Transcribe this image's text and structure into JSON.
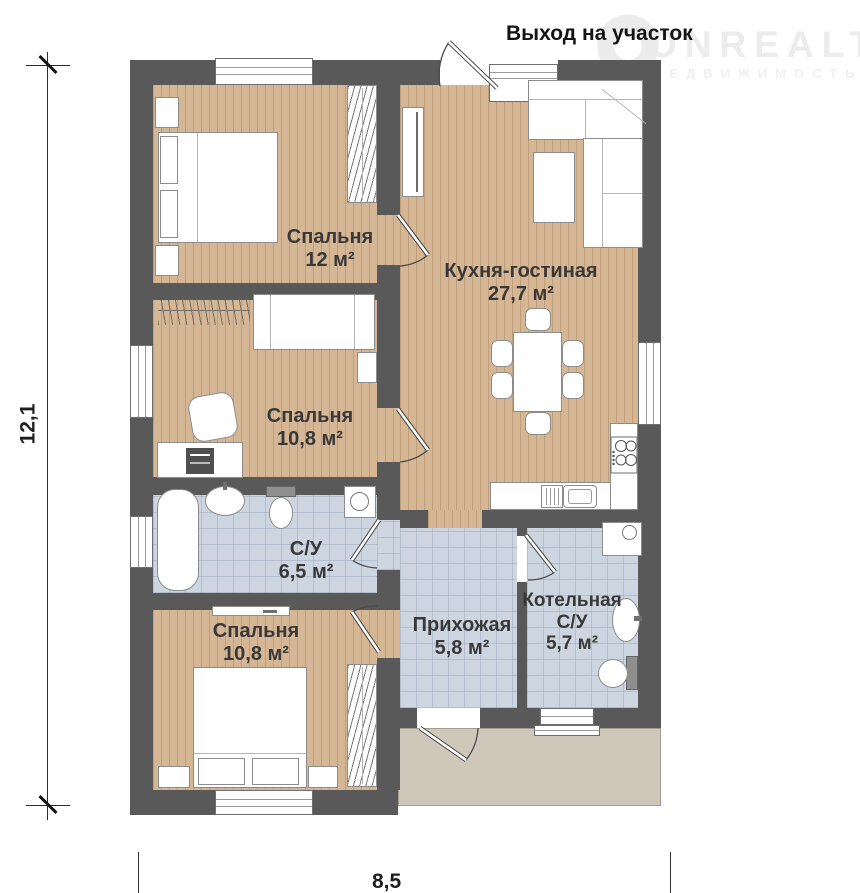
{
  "watermark": {
    "brand": "ONREALT",
    "subtitle": "НЕДВИЖИМОСТЬ"
  },
  "annotations": {
    "exit": "Выход на участок"
  },
  "dimensions": {
    "height_m": "12,1",
    "width_m": "8,5"
  },
  "rooms": {
    "bedroom1": {
      "name": "Спальня",
      "area": "12 м²"
    },
    "kitchen": {
      "name": "Кухня-гостиная",
      "area": "27,7 м²"
    },
    "bedroom2": {
      "name": "Спальня",
      "area": "10,8 м²"
    },
    "bathroom": {
      "name": "С/У",
      "area": "6,5 м²"
    },
    "bedroom3": {
      "name": "Спальня",
      "area": "10,8 м²"
    },
    "hallway": {
      "name": "Прихожая",
      "area": "5,8 м²"
    },
    "boiler": {
      "name": "Котельная",
      "name2": "С/У",
      "area": "5,7 м²"
    }
  },
  "colors": {
    "wall": "#595959",
    "wood_floor": "#d6b795",
    "tile_floor": "#cdd6e0",
    "porch": "#cfc8ba"
  }
}
